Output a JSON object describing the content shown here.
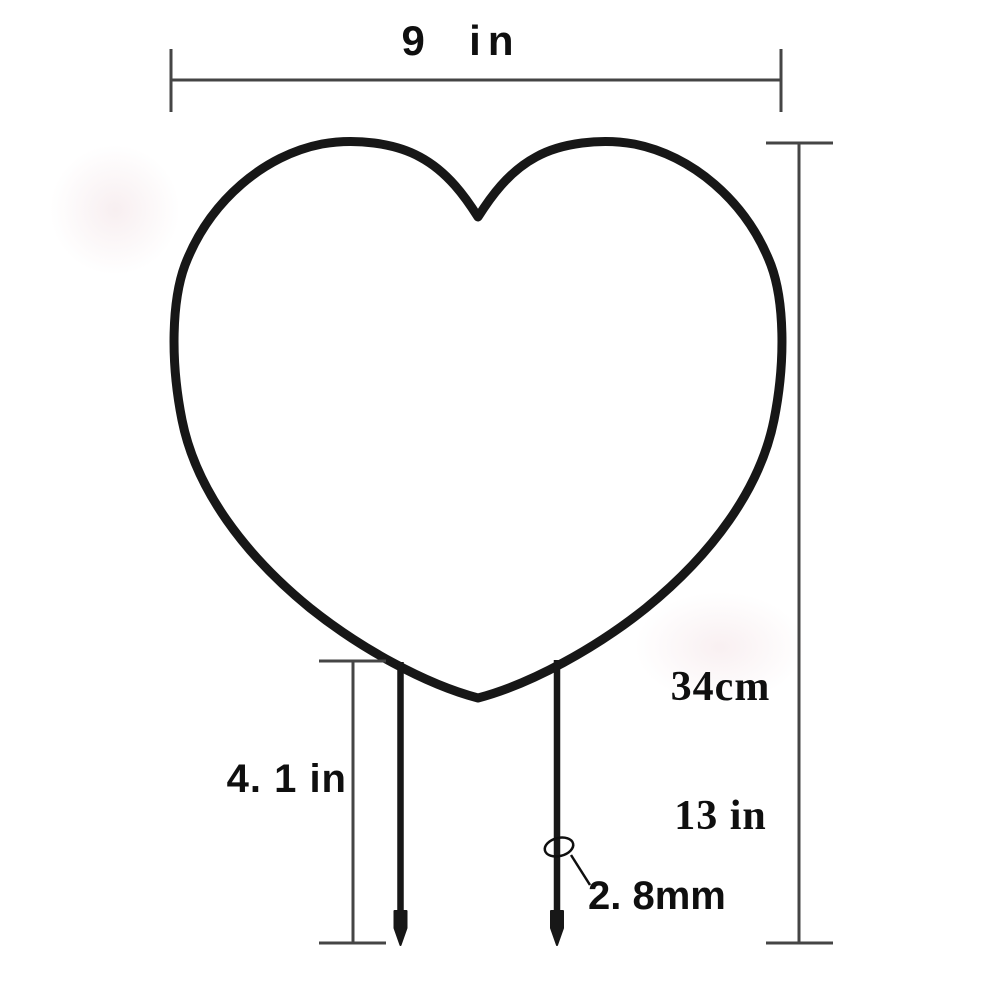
{
  "figure": {
    "name": "heart-shaped wire frame with two ground stakes",
    "view": "front dimension diagram"
  },
  "dimensions": {
    "width_label": "9  in",
    "height_primary": "34cm",
    "height_secondary": "13 in",
    "stake_length_label": "4. 1 in",
    "wire_thickness_label": "2. 8mm"
  },
  "colors": {
    "background": "#ffffff",
    "wire": "#171717",
    "dimension_line": "#454545",
    "text": "#0f0f0f"
  }
}
